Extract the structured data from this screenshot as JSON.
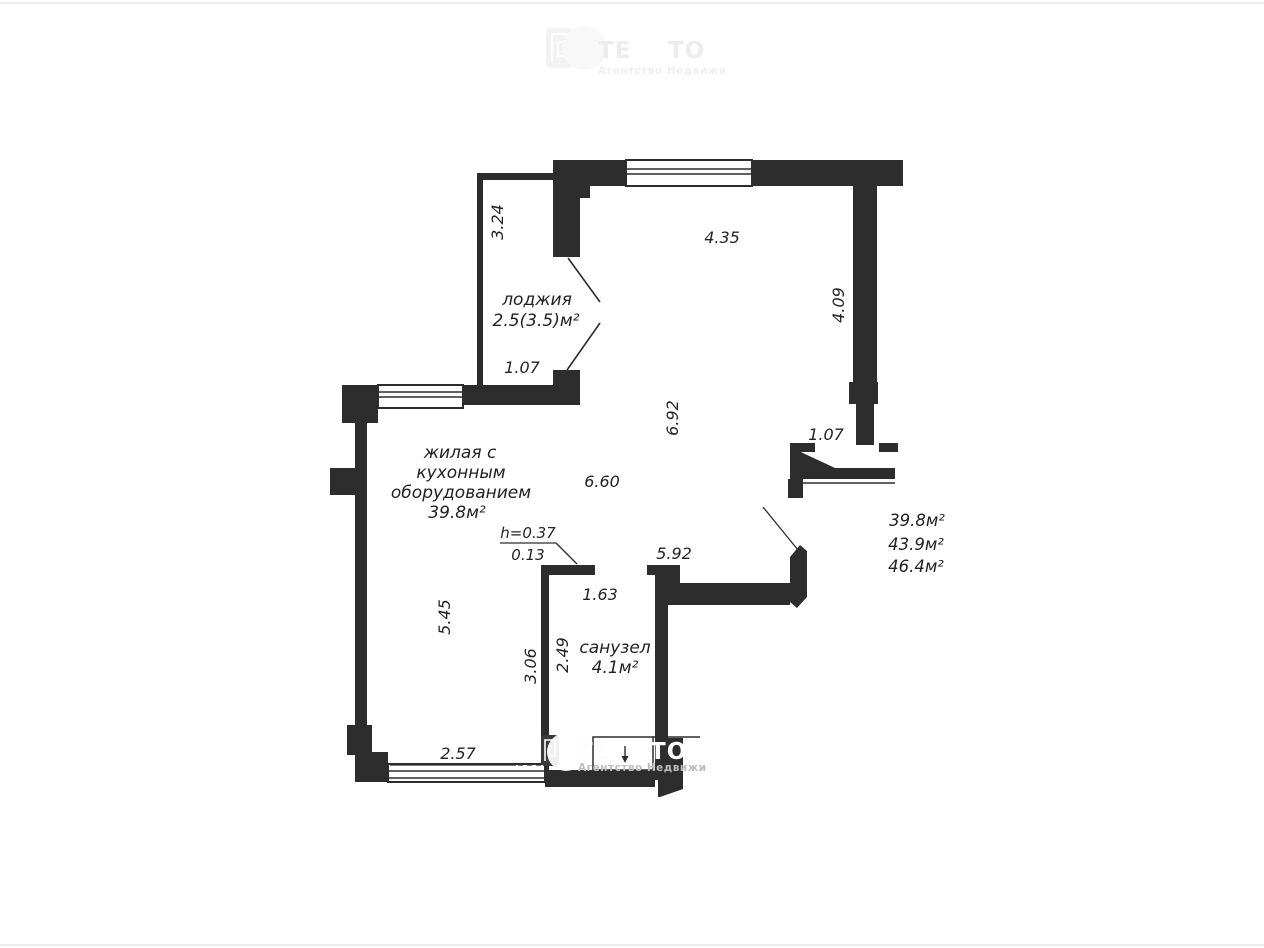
{
  "plan": {
    "rooms": {
      "loggia": {
        "name": "лоджия",
        "area": "2.5(3.5)м²"
      },
      "living": {
        "line1": "жилая с",
        "line2": "кухонным",
        "line3": "оборудованием",
        "area": "39.8м²"
      },
      "bathroom": {
        "name": "санузел",
        "area": "4.1м²"
      }
    },
    "dimensions": {
      "loggia_length": "3.24",
      "loggia_door": "1.07",
      "top_width": "4.35",
      "right_height": "4.09",
      "living_height_mid": "6.92",
      "entry_door": "1.07",
      "living_width": "6.60",
      "south_width": "5.92",
      "bath_width": "1.63",
      "left_height": "5.45",
      "bath_outer_height": "3.06",
      "bath_inner_height": "2.49",
      "bottom_width": "2.57"
    },
    "step": {
      "height": "h=0.37",
      "width": "0.13"
    },
    "totals": {
      "t1": "39.8м²",
      "t2": "43.9м²",
      "t3": "46.4м²"
    },
    "colors": {
      "wall": "#2d2d2d",
      "background": "#ffffff"
    }
  },
  "watermark": {
    "brand_left": "ТЕ",
    "brand_right": "ТО",
    "subtitle": "Агентство Недвижи"
  }
}
